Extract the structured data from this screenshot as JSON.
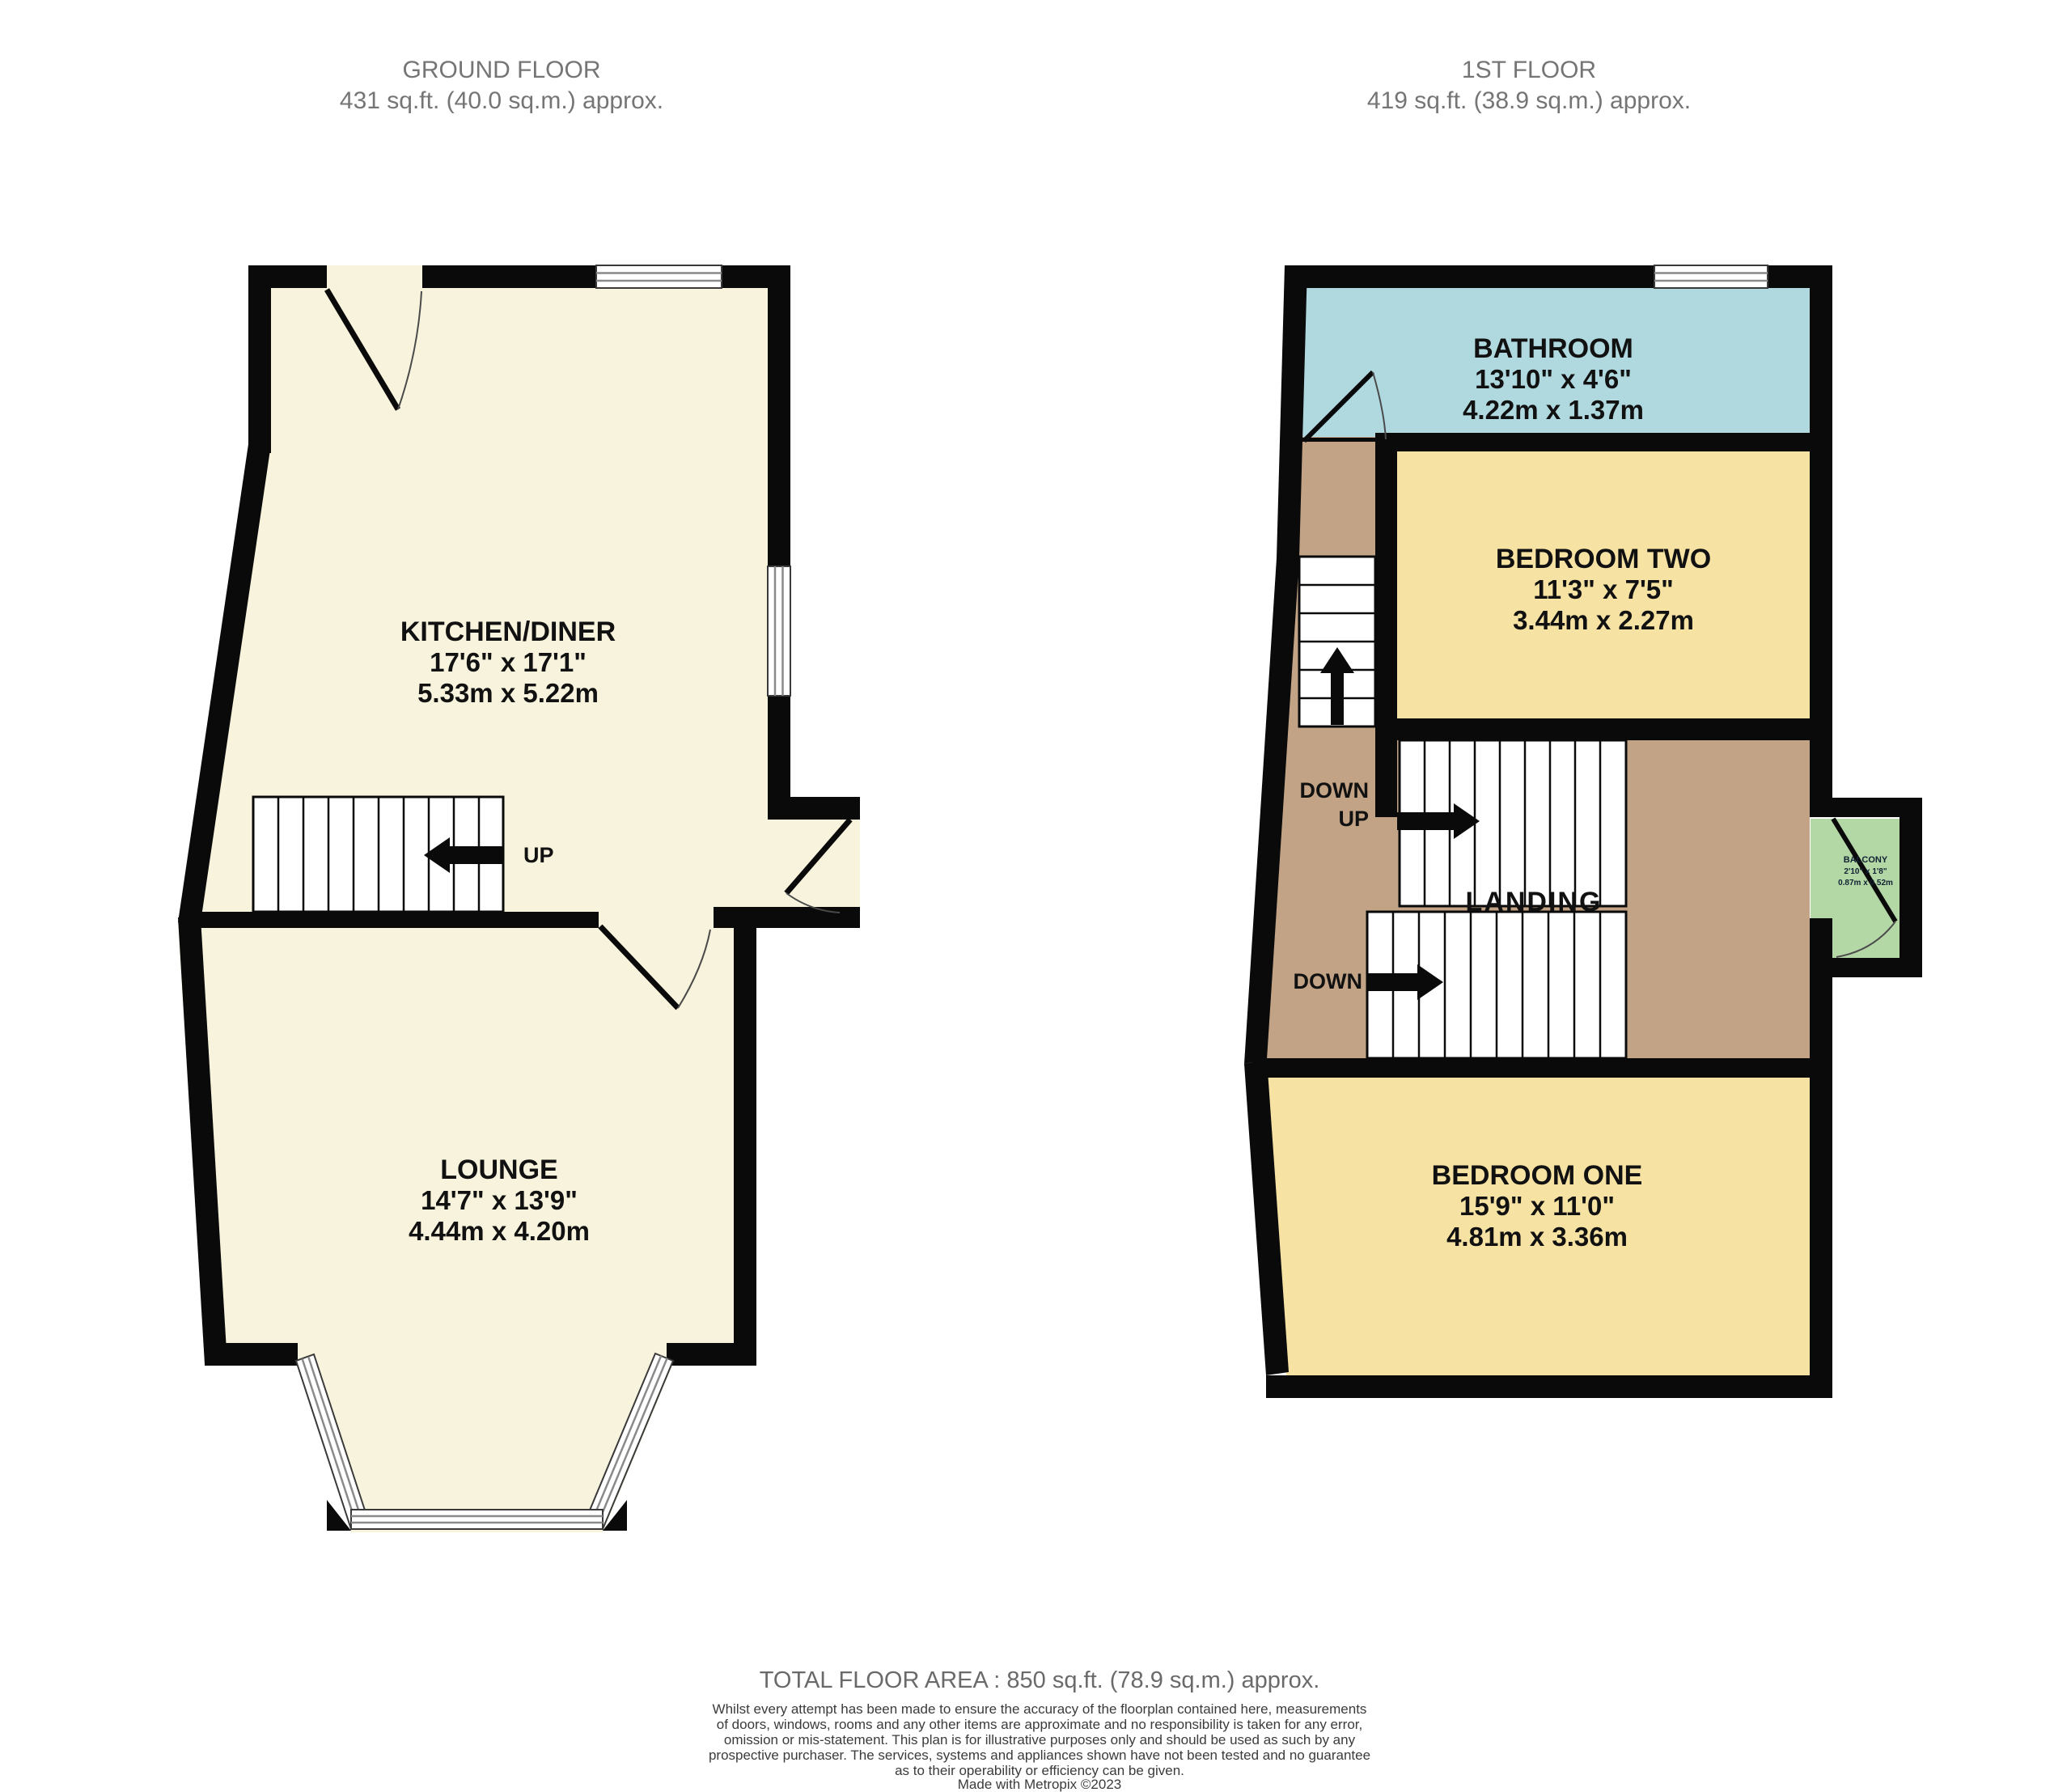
{
  "colors": {
    "wall": "#0a0a0a",
    "ground_floor_fill": "#f8f3dc",
    "bedroom_fill": "#f6e2a2",
    "bathroom_fill": "#afd8df",
    "landing_fill": "#c2a385",
    "balcony_fill": "#b4d7a6",
    "header_gray": "#757575",
    "disclaimer_gray": "#3b3b3b"
  },
  "ground_floor": {
    "title": "GROUND FLOOR",
    "area": "431 sq.ft. (40.0 sq.m.) approx.",
    "kitchen_diner": {
      "name": "KITCHEN/DINER",
      "imperial": "17'6\"  x 17'1\"",
      "metric": "5.33m  x 5.22m"
    },
    "lounge": {
      "name": "LOUNGE",
      "imperial": "14'7\"  x 13'9\"",
      "metric": "4.44m  x 4.20m"
    },
    "stairs_up_label": "UP"
  },
  "first_floor": {
    "title": "1ST FLOOR",
    "area": "419 sq.ft. (38.9 sq.m.) approx.",
    "bathroom": {
      "name": "BATHROOM",
      "imperial": "13'10\"  x 4'6\"",
      "metric": "4.22m  x 1.37m"
    },
    "bedroom_two": {
      "name": "BEDROOM TWO",
      "imperial": "11'3\"  x 7'5\"",
      "metric": "3.44m  x 2.27m"
    },
    "bedroom_one": {
      "name": "BEDROOM ONE",
      "imperial": "15'9\"  x 11'0\"",
      "metric": "4.81m  x 3.36m"
    },
    "landing": {
      "name": "LANDING"
    },
    "balcony": {
      "name": "BALCONY",
      "imperial": "2'10\" x 1'8\"",
      "metric": "0.87m x 0.52m"
    },
    "stair_labels": {
      "upper_down": "DOWN",
      "upper_up": "UP",
      "lower_down": "DOWN"
    }
  },
  "footer": {
    "total_area": "TOTAL FLOOR AREA : 850 sq.ft. (78.9 sq.m.) approx.",
    "disclaimer_lines": [
      "Whilst every attempt has been made to ensure the accuracy of the floorplan contained here, measurements",
      "of doors, windows, rooms and any other items are approximate and no responsibility is taken for any error,",
      "omission or mis-statement. This plan is for illustrative purposes only and should be used as such by any",
      "prospective purchaser. The services, systems and appliances shown have not been tested and no guarantee",
      "as to their operability or efficiency can be given."
    ],
    "credit": "Made with Metropix ©2023"
  }
}
